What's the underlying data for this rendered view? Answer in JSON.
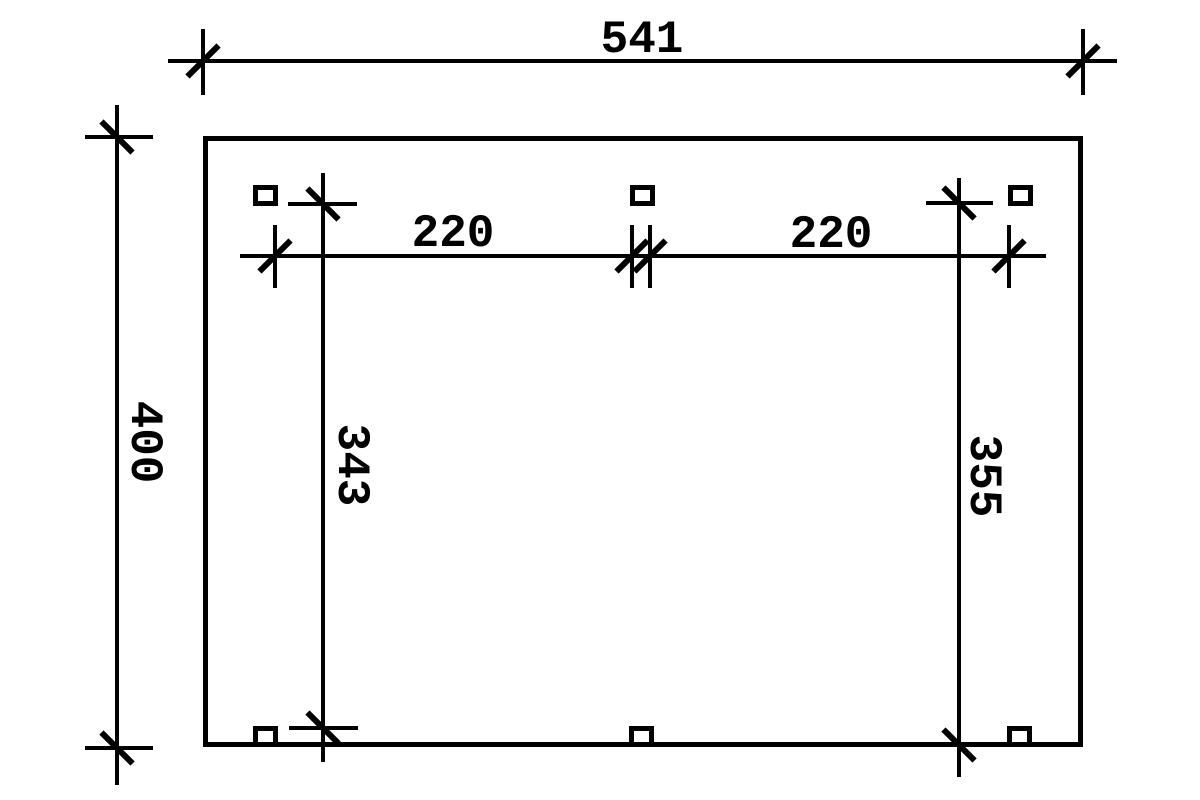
{
  "drawing": {
    "type": "floor-plan-dimension-drawing",
    "colors": {
      "line": "#000000",
      "background": "#ffffff"
    },
    "dimensions": {
      "total_width": {
        "value": "541",
        "orientation": "horizontal"
      },
      "total_depth": {
        "value": "400",
        "orientation": "vertical"
      },
      "clear_span_left": {
        "value": "220",
        "orientation": "horizontal"
      },
      "clear_span_right": {
        "value": "220",
        "orientation": "horizontal"
      },
      "inner_depth_left": {
        "value": "343",
        "orientation": "vertical"
      },
      "inner_depth_right": {
        "value": "355",
        "orientation": "vertical"
      }
    },
    "post_count": 6
  }
}
